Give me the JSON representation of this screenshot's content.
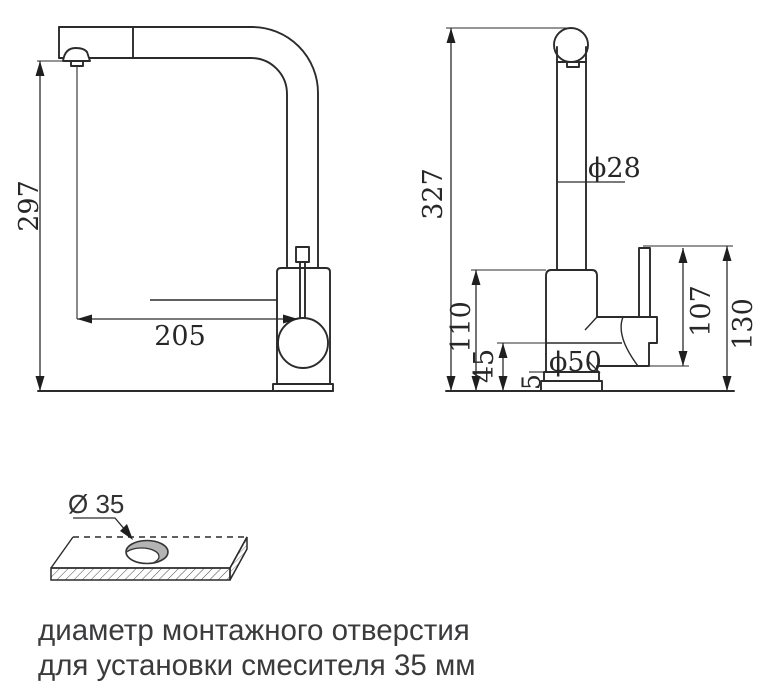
{
  "side_view": {
    "height_dim": "297",
    "reach_dim": "205"
  },
  "front_view": {
    "overall_height_dim": "327",
    "spout_diameter_dim": "ϕ28",
    "body_height_dim": "110",
    "lower_body_dim": "45",
    "base_plate_dim": "5",
    "body_diameter_dim": "ϕ50",
    "handle_height_dim": "107",
    "overall_right_dim": "130"
  },
  "mount_hole": {
    "diameter_label": "Ø 35"
  },
  "caption": {
    "line1": "диаметр монтажного отверстия",
    "line2": "для установки смесителя 35 мм"
  },
  "colors": {
    "line": "#2b2b2b",
    "caption_text": "#3b3b3d",
    "hole_fill": "#b4b4b4",
    "background": "#ffffff"
  }
}
